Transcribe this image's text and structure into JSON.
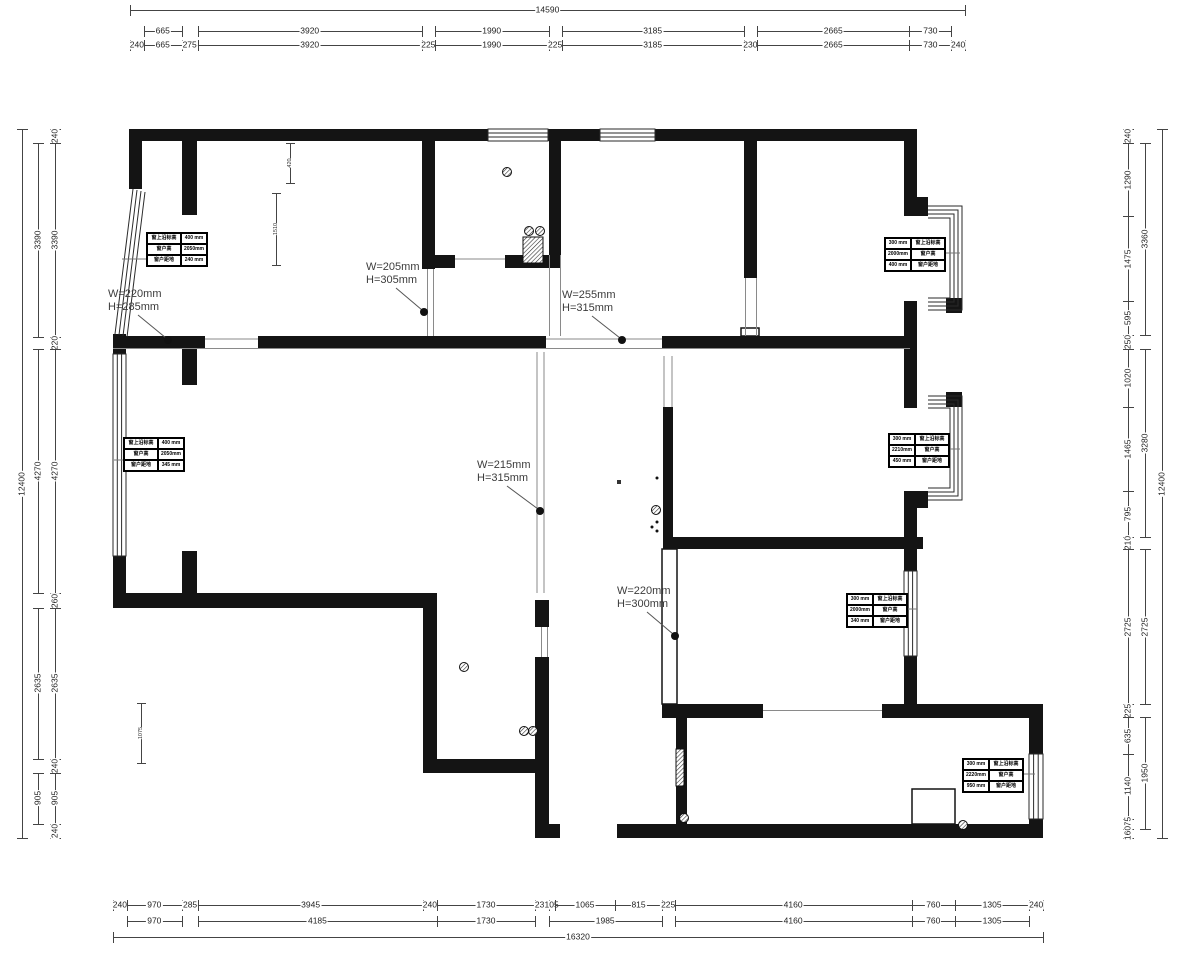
{
  "meta": {
    "bg": "#ffffff",
    "wall_color": "#141414",
    "thin_color": "#8a8a8a",
    "dim_color": "#3a3a3a",
    "drawing_type": "residential floor plan, survey dimensions"
  },
  "dimensions": {
    "top": {
      "dir": "h",
      "mm_total": 14590,
      "px": [
        130,
        965
      ],
      "rows": [
        {
          "offset": 10,
          "segs": [
            {
              "l": "14590",
              "a": 0,
              "b": 14590
            }
          ]
        },
        {
          "offset": 31,
          "segs": [
            {
              "l": "665",
              "a": 240,
              "b": 905
            },
            {
              "l": "3920",
              "a": 1180,
              "b": 5100
            },
            {
              "l": "1990",
              "a": 5325,
              "b": 7315
            },
            {
              "l": "3185",
              "a": 7540,
              "b": 10725
            },
            {
              "l": "2665",
              "a": 10955,
              "b": 13620
            },
            {
              "l": "730",
              "a": 13620,
              "b": 14350
            }
          ]
        },
        {
          "offset": 45,
          "segs": [
            {
              "l": "240",
              "a": 0,
              "b": 240
            },
            {
              "l": "665",
              "a": 240,
              "b": 905
            },
            {
              "l": "275",
              "a": 905,
              "b": 1180
            },
            {
              "l": "3920",
              "a": 1180,
              "b": 5100
            },
            {
              "l": "225",
              "a": 5100,
              "b": 5325
            },
            {
              "l": "1990",
              "a": 5325,
              "b": 7315
            },
            {
              "l": "225",
              "a": 7315,
              "b": 7540
            },
            {
              "l": "3185",
              "a": 7540,
              "b": 10725
            },
            {
              "l": "230",
              "a": 10725,
              "b": 10955
            },
            {
              "l": "2665",
              "a": 10955,
              "b": 13620
            },
            {
              "l": "730",
              "a": 13620,
              "b": 14350
            },
            {
              "l": "240",
              "a": 14350,
              "b": 14590
            }
          ]
        }
      ]
    },
    "bottom": {
      "dir": "h",
      "mm_total": 16320,
      "px": [
        113,
        1043
      ],
      "rows": [
        {
          "offset": 905,
          "segs": [
            {
              "l": "240",
              "a": 0,
              "b": 240
            },
            {
              "l": "970",
              "a": 240,
              "b": 1210
            },
            {
              "l": "285",
              "a": 1210,
              "b": 1495
            },
            {
              "l": "3945",
              "a": 1495,
              "b": 5440
            },
            {
              "l": "240",
              "a": 5440,
              "b": 5680
            },
            {
              "l": "1730",
              "a": 5680,
              "b": 7410
            },
            {
              "l": "235",
              "a": 7410,
              "b": 7645
            },
            {
              "l": "105",
              "a": 7645,
              "b": 7750
            },
            {
              "l": "1065",
              "a": 7750,
              "b": 8815
            },
            {
              "l": "815",
              "a": 8815,
              "b": 9630
            },
            {
              "l": "225",
              "a": 9630,
              "b": 9855
            },
            {
              "l": "4160",
              "a": 9855,
              "b": 14015
            },
            {
              "l": "760",
              "a": 14015,
              "b": 14775
            },
            {
              "l": "1305",
              "a": 14775,
              "b": 16080
            },
            {
              "l": "240",
              "a": 16080,
              "b": 16320
            }
          ]
        },
        {
          "offset": 921,
          "segs": [
            {
              "l": "970",
              "a": 240,
              "b": 1210
            },
            {
              "l": "4185",
              "a": 1495,
              "b": 5680
            },
            {
              "l": "1730",
              "a": 5680,
              "b": 7410
            },
            {
              "l": "1985",
              "a": 7645,
              "b": 9630
            },
            {
              "l": "4160",
              "a": 9855,
              "b": 14015
            },
            {
              "l": "760",
              "a": 14015,
              "b": 14775
            },
            {
              "l": "1305",
              "a": 14775,
              "b": 16080
            }
          ]
        },
        {
          "offset": 937,
          "segs": [
            {
              "l": "16320",
              "a": 0,
              "b": 16320
            }
          ]
        }
      ]
    },
    "left": {
      "dir": "v",
      "mm_total": 12400,
      "px": [
        129,
        838
      ],
      "rows": [
        {
          "offset": 22,
          "segs": [
            {
              "l": "12400",
              "a": 0,
              "b": 12400
            }
          ]
        },
        {
          "offset": 38,
          "segs": [
            {
              "l": "3390",
              "a": 240,
              "b": 3630
            },
            {
              "l": "4270",
              "a": 3850,
              "b": 8120
            },
            {
              "l": "2635",
              "a": 8380,
              "b": 11015
            },
            {
              "l": "905",
              "a": 11255,
              "b": 12160
            }
          ]
        },
        {
          "offset": 55,
          "segs": [
            {
              "l": "240",
              "a": 0,
              "b": 240
            },
            {
              "l": "3390",
              "a": 240,
              "b": 3630
            },
            {
              "l": "220",
              "a": 3630,
              "b": 3850
            },
            {
              "l": "4270",
              "a": 3850,
              "b": 8120
            },
            {
              "l": "260",
              "a": 8120,
              "b": 8380
            },
            {
              "l": "2635",
              "a": 8380,
              "b": 11015
            },
            {
              "l": "240",
              "a": 11015,
              "b": 11255
            },
            {
              "l": "905",
              "a": 11255,
              "b": 12160
            },
            {
              "l": "240",
              "a": 12160,
              "b": 12400
            }
          ]
        }
      ]
    },
    "right": {
      "dir": "v",
      "mm_total": 12400,
      "px": [
        129,
        838
      ],
      "rows": [
        {
          "offset": 1128,
          "segs": [
            {
              "l": "240",
              "a": 0,
              "b": 240
            },
            {
              "l": "1290",
              "a": 240,
              "b": 1530
            },
            {
              "l": "1475",
              "a": 1530,
              "b": 3005
            },
            {
              "l": "595",
              "a": 3005,
              "b": 3600
            },
            {
              "l": "250",
              "a": 3600,
              "b": 3850
            },
            {
              "l": "1020",
              "a": 3850,
              "b": 4870
            },
            {
              "l": "1465",
              "a": 4870,
              "b": 6335
            },
            {
              "l": "795",
              "a": 6335,
              "b": 7130
            },
            {
              "l": "210",
              "a": 7130,
              "b": 7340
            },
            {
              "l": "2725",
              "a": 7340,
              "b": 10065
            },
            {
              "l": "225",
              "a": 10065,
              "b": 10290
            },
            {
              "l": "635",
              "a": 10290,
              "b": 10925
            },
            {
              "l": "1140",
              "a": 10925,
              "b": 12065
            },
            {
              "l": "175",
              "a": 12065,
              "b": 12240
            },
            {
              "l": "160",
              "a": 12240,
              "b": 12400
            }
          ]
        },
        {
          "offset": 1145,
          "segs": [
            {
              "l": "3360",
              "a": 240,
              "b": 3600
            },
            {
              "l": "3280",
              "a": 3850,
              "b": 7130
            },
            {
              "l": "2725",
              "a": 7340,
              "b": 10065
            },
            {
              "l": "1950",
              "a": 10290,
              "b": 12240
            }
          ]
        },
        {
          "offset": 1162,
          "segs": [
            {
              "l": "12400",
              "a": 0,
              "b": 12400
            }
          ]
        }
      ]
    }
  },
  "beam_labels": [
    {
      "w": "W=220mm",
      "h": "H=285mm",
      "x": 108,
      "y": 288,
      "dot": [
        168,
        340
      ]
    },
    {
      "w": "W=205mm",
      "h": "H=305mm",
      "x": 366,
      "y": 261,
      "dot": [
        424,
        312
      ]
    },
    {
      "w": "W=255mm",
      "h": "H=315mm",
      "x": 562,
      "y": 289,
      "dot": [
        622,
        340
      ]
    },
    {
      "w": "W=215mm",
      "h": "H=315mm",
      "x": 477,
      "y": 459,
      "dot": [
        540,
        511
      ]
    },
    {
      "w": "W=220mm",
      "h": "H=300mm",
      "x": 617,
      "y": 585,
      "dot": [
        675,
        636
      ]
    }
  ],
  "window_tables": [
    {
      "x": 146,
      "y": 232,
      "value_side": "right",
      "leader": [
        146,
        259,
        122,
        259
      ],
      "rows": [
        {
          "label": "窗上沿标高",
          "value": "400 mm"
        },
        {
          "label": "窗户高",
          "value": "2050mm"
        },
        {
          "label": "窗户距地",
          "value": "240 mm"
        }
      ]
    },
    {
      "x": 123,
      "y": 437,
      "value_side": "right",
      "leader": [
        123,
        460,
        114,
        460
      ],
      "rows": [
        {
          "label": "窗上沿标高",
          "value": "400 mm"
        },
        {
          "label": "窗户高",
          "value": "2050mm"
        },
        {
          "label": "窗户距地",
          "value": "345 mm"
        }
      ]
    },
    {
      "x": 884,
      "y": 237,
      "value_side": "left",
      "leader": [
        944,
        253,
        960,
        253
      ],
      "rows": [
        {
          "label": "窗上沿标高",
          "value": "300 mm"
        },
        {
          "label": "窗户高",
          "value": "2000mm"
        },
        {
          "label": "窗户距地",
          "value": "400 mm"
        }
      ]
    },
    {
      "x": 888,
      "y": 433,
      "value_side": "left",
      "leader": [
        948,
        449,
        960,
        449
      ],
      "rows": [
        {
          "label": "窗上沿标高",
          "value": "300 mm"
        },
        {
          "label": "窗户高",
          "value": "2210mm"
        },
        {
          "label": "窗户距地",
          "value": "450 mm"
        }
      ]
    },
    {
      "x": 846,
      "y": 593,
      "value_side": "left",
      "leader": [
        906,
        609,
        917,
        609
      ],
      "rows": [
        {
          "label": "窗上沿标高",
          "value": "300 mm"
        },
        {
          "label": "窗户高",
          "value": "2000mm"
        },
        {
          "label": "窗户距地",
          "value": "340 mm"
        }
      ]
    },
    {
      "x": 962,
      "y": 758,
      "value_side": "left",
      "leader": [
        1022,
        774,
        1035,
        774
      ],
      "rows": [
        {
          "label": "窗上沿标高",
          "value": "300 mm"
        },
        {
          "label": "窗户高",
          "value": "2220mm"
        },
        {
          "label": "窗户距地",
          "value": "950 mm"
        }
      ]
    }
  ],
  "room_dims": [
    {
      "x": 290,
      "y1": 143,
      "y2": 183,
      "l": "420"
    },
    {
      "x": 276,
      "y1": 193,
      "y2": 265,
      "l": "1510"
    },
    {
      "x": 141,
      "y1": 703,
      "y2": 763,
      "l": "1075"
    }
  ],
  "symbols": {
    "drains": [
      [
        507,
        172
      ],
      [
        529,
        231
      ],
      [
        540,
        231
      ],
      [
        656,
        510
      ],
      [
        464,
        667
      ],
      [
        524,
        731
      ],
      [
        533,
        731
      ],
      [
        684,
        818
      ],
      [
        963,
        825
      ]
    ],
    "dots": [
      [
        657,
        478
      ],
      [
        657,
        522
      ],
      [
        652,
        527
      ],
      [
        657,
        531
      ]
    ],
    "squares": [
      [
        619,
        482
      ]
    ],
    "radiators": [
      [
        523,
        237,
        20,
        26
      ],
      [
        676,
        749,
        8,
        37
      ]
    ]
  }
}
